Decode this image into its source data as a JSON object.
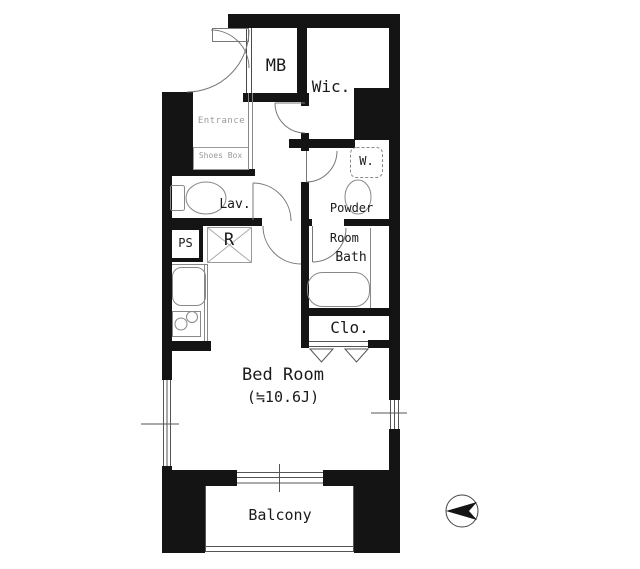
{
  "plan": {
    "rooms": {
      "mb": "MB",
      "wic": "Wic.",
      "entrance": "Entrance",
      "shoes_box": "Shoes Box",
      "washer": "W.",
      "powder_room_line1": "Powder",
      "powder_room_line2": "Room",
      "lav": "Lav.",
      "ps": "PS",
      "refrigerator": "R",
      "bath": "Bath",
      "closet": "Clo.",
      "bed_room": "Bed Room",
      "bed_room_size": "(≒10.6J)",
      "balcony": "Balcony"
    },
    "icons": {
      "compass": "north-compass-icon"
    },
    "colors": {
      "wall": "#141414",
      "line": "#4a4a4a",
      "label": "#1a1a1a",
      "muted_label": "#9a9a9a"
    }
  }
}
